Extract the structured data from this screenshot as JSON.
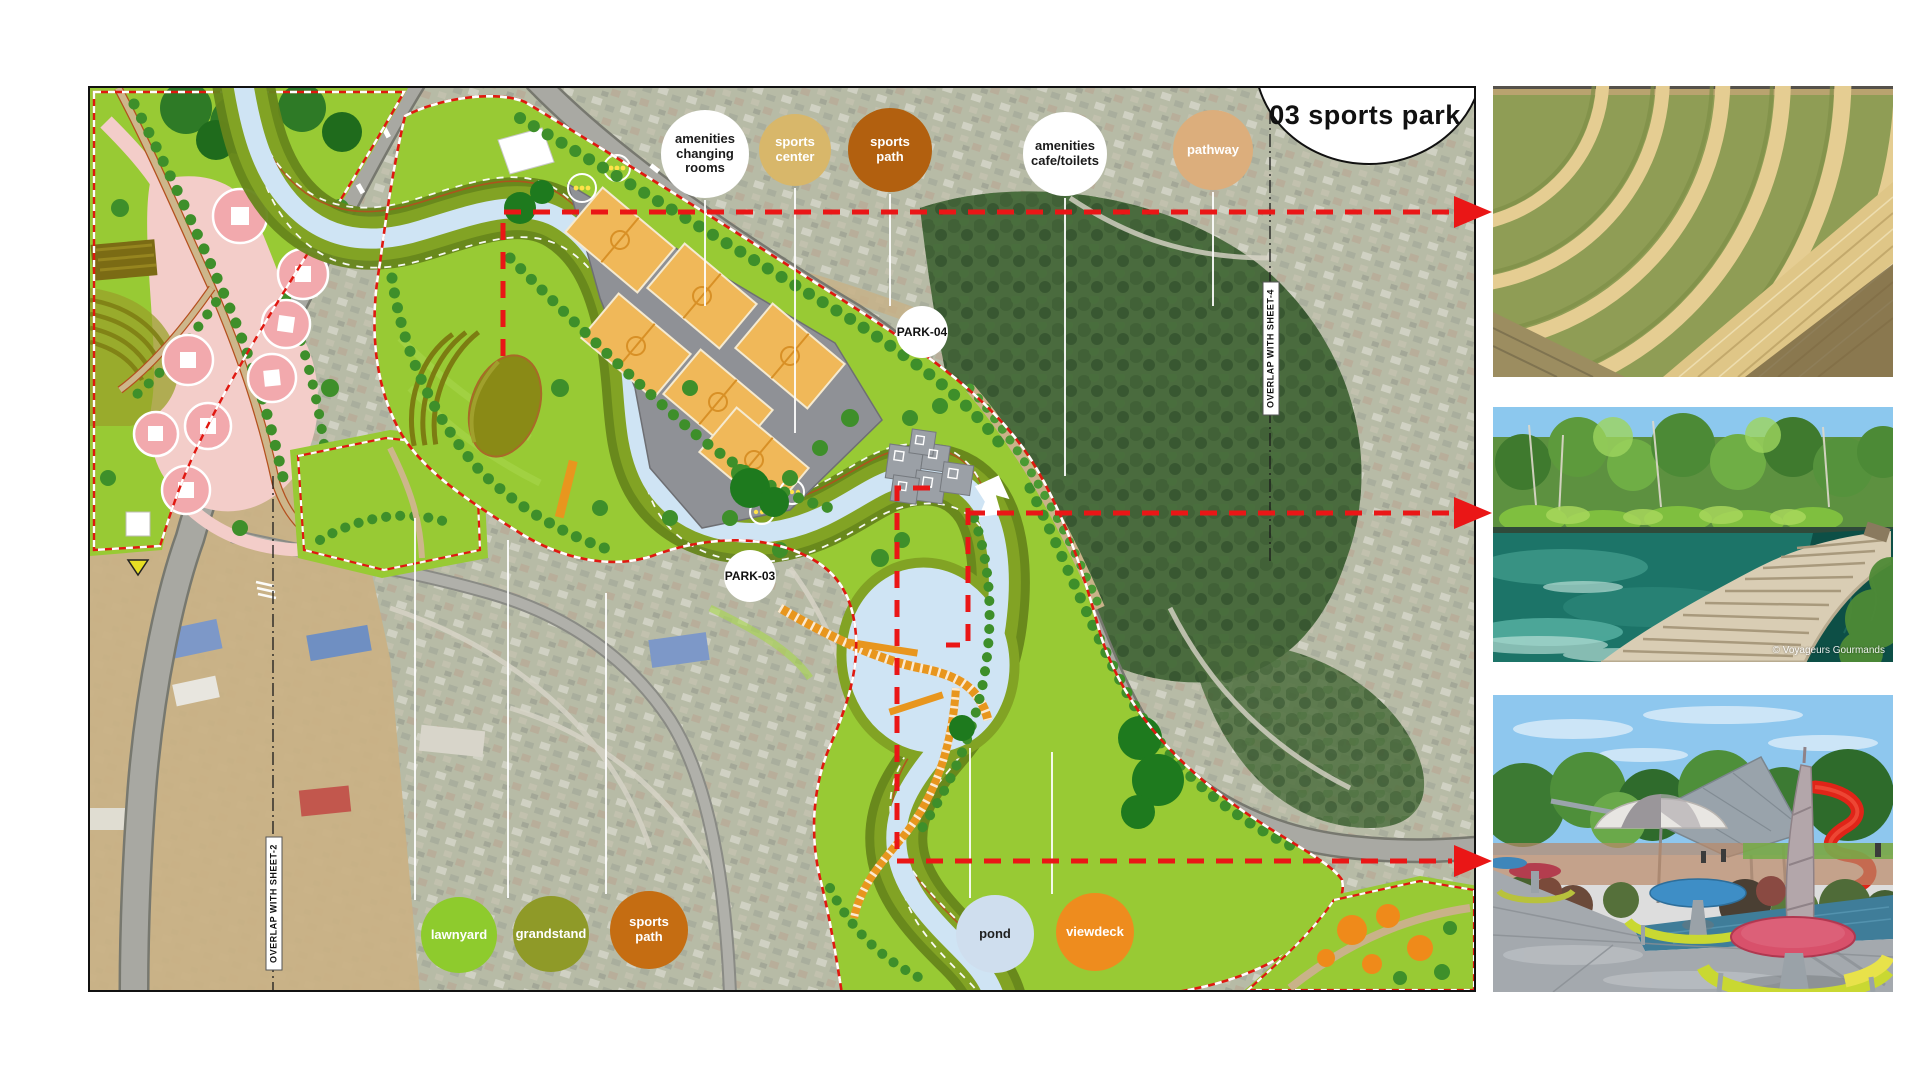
{
  "title": "03 sports park",
  "plan": {
    "top_labels": [
      {
        "label": "amenities\nchanging\nrooms",
        "bg": "#ffffff",
        "fg": "#1a1a1a"
      },
      {
        "label": "sports\ncenter",
        "bg": "#d8b76a",
        "fg": "#ffffff"
      },
      {
        "label": "sports\npath",
        "bg": "#b2600f",
        "fg": "#ffffff"
      },
      {
        "label": "amenities\ncafe/toilets",
        "bg": "#ffffff",
        "fg": "#1a1a1a"
      },
      {
        "label": "pathway",
        "bg": "#dcae7c",
        "fg": "#ffffff"
      }
    ],
    "bottom_labels": [
      {
        "label": "lawnyard",
        "bg": "#8ecb2d",
        "fg": "#ffffff"
      },
      {
        "label": "grandstand",
        "bg": "#8f9a28",
        "fg": "#ffffff"
      },
      {
        "label": "sports\npath",
        "bg": "#c56d12",
        "fg": "#ffffff"
      },
      {
        "label": "pond",
        "bg": "#cfdeee",
        "fg": "#1f1f1f"
      },
      {
        "label": "viewdeck",
        "bg": "#ee8c1e",
        "fg": "#ffffff"
      }
    ],
    "markers": [
      {
        "label": "PARK-04"
      },
      {
        "label": "PARK-03"
      }
    ],
    "overlap_labels": [
      {
        "label": "OVERLAP WITH SHEET-4"
      },
      {
        "label": "OVERLAP WITH SHEET-2"
      }
    ]
  },
  "photos": [
    {
      "name": "grass-amphitheater-photo"
    },
    {
      "name": "lake-boardwalk-photo",
      "watermark": "© Voyageurs Gourmands"
    },
    {
      "name": "playground-picnic-terrace-photo"
    }
  ],
  "colors": {
    "park_green": "#98ca34",
    "river_blue": "#cfe4f4",
    "court_orange": "#f0b859",
    "callout_red": "#ea1616",
    "aerial_base": "#b7bba6"
  }
}
